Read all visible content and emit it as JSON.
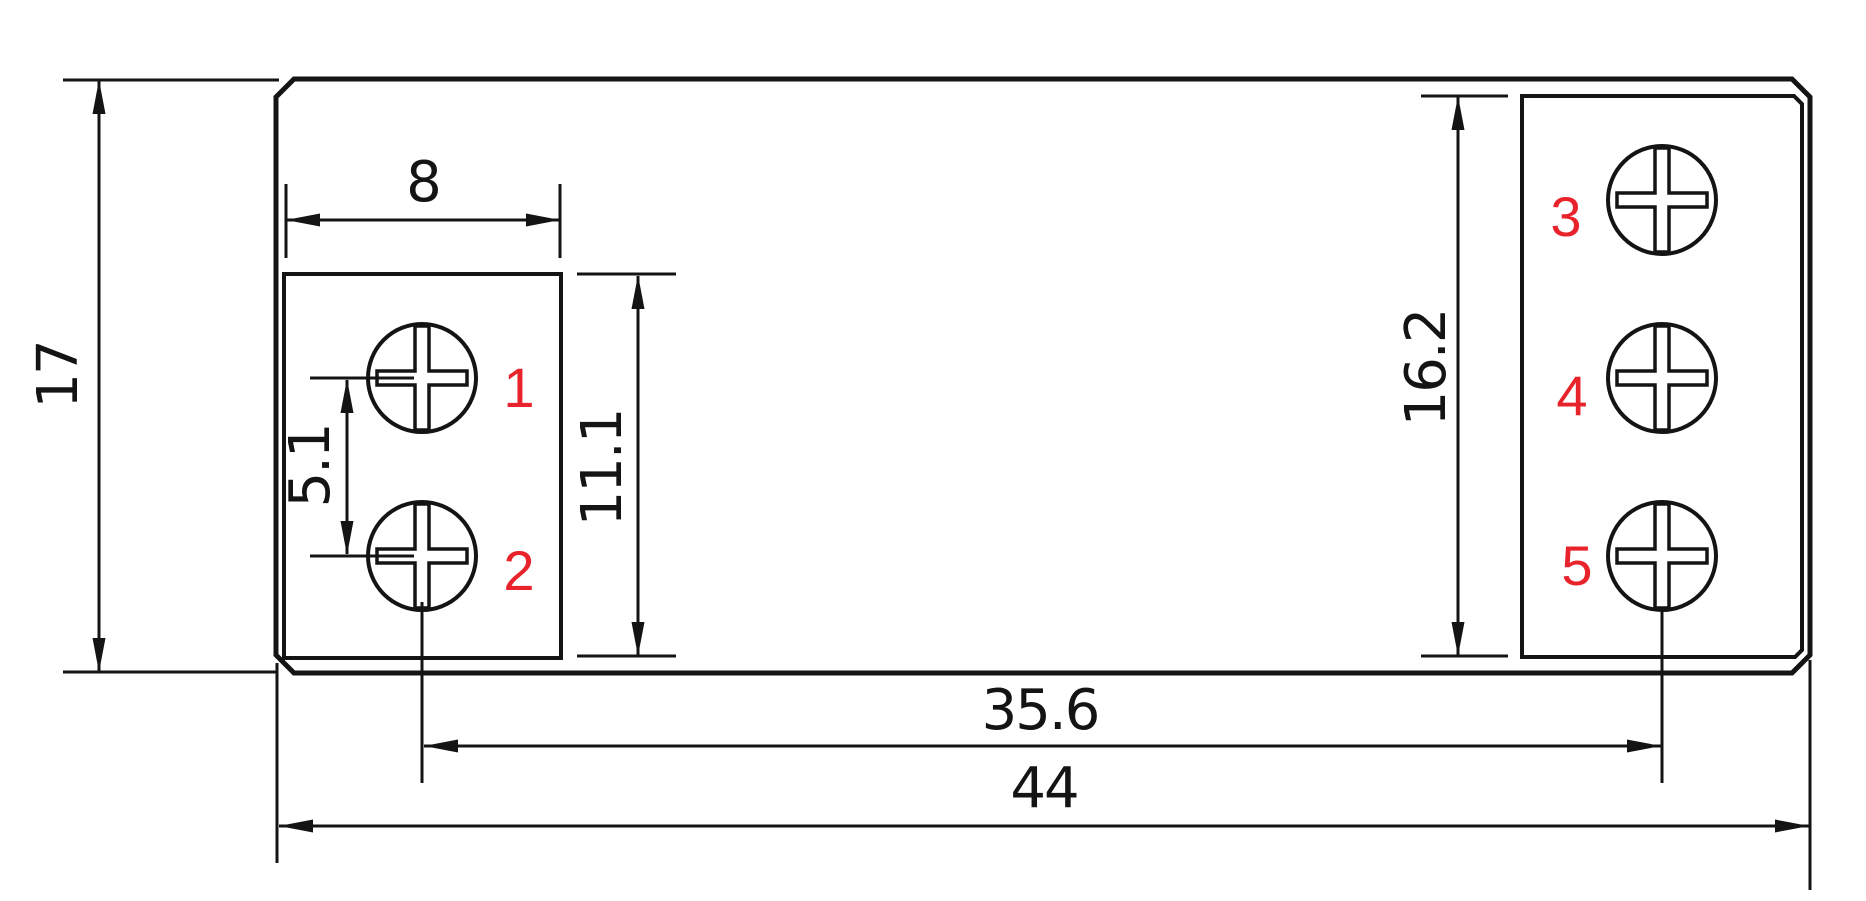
{
  "drawing": {
    "type": "technical-dimension-drawing",
    "background": "#ffffff",
    "colors": {
      "line": "#141414",
      "terminal_label": "#e8232b"
    },
    "dimensions": {
      "body_height": "17",
      "left_block_width": "8",
      "screw_pitch": "5.1",
      "left_block_height": "11.1",
      "right_block_height": "16.2",
      "screw_span": "35.6",
      "body_width": "44"
    },
    "terminals": {
      "t1": "1",
      "t2": "2",
      "t3": "3",
      "t4": "4",
      "t5": "5"
    }
  }
}
